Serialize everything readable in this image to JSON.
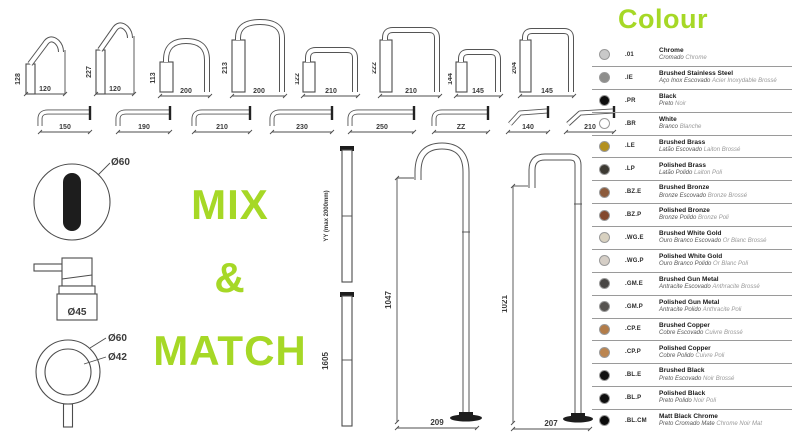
{
  "accent_green": "#a6d826",
  "mix_match": {
    "line1": "MIX",
    "line2": "&",
    "line3": "MATCH"
  },
  "top_spouts": [
    {
      "h": "128",
      "w": "120"
    },
    {
      "h": "227",
      "w": "120"
    },
    {
      "h": "113",
      "w": "200"
    },
    {
      "h": "213",
      "w": "200"
    },
    {
      "h": "122",
      "w": "210"
    },
    {
      "h": "222",
      "w": "210"
    },
    {
      "h": "144",
      "w": "145"
    },
    {
      "h": "204",
      "w": "145"
    }
  ],
  "wall_spouts": [
    {
      "w": "150"
    },
    {
      "w": "190"
    },
    {
      "w": "210"
    },
    {
      "w": "230"
    },
    {
      "w": "250"
    },
    {
      "w": "ZZ"
    },
    {
      "w": "140"
    },
    {
      "w": "210"
    }
  ],
  "handles": {
    "oval_dia": "Ø60",
    "cylinder_dia": "Ø45",
    "ring_outer_dia": "Ø60",
    "ring_inner_dia": "Ø42"
  },
  "risers": [
    {
      "label": "YY (max 2000mm)"
    },
    {
      "label": "1605"
    }
  ],
  "floor_spouts": [
    {
      "h": "1047",
      "w": "209"
    },
    {
      "h": "1021",
      "w": "207"
    }
  ],
  "colour": {
    "title": "Colour",
    "items": [
      {
        "code": ".01",
        "name": "Chrome",
        "sub_pt": "Cromado",
        "sub_fr": "Chrome",
        "hex": "#c9c9c9"
      },
      {
        "code": ".IE",
        "name": "Brushed Stainless Steel",
        "sub_pt": "Aço Inox Escovado",
        "sub_fr": "Acier Inoxydable Brossé",
        "hex": "#8e8e8c"
      },
      {
        "code": ".PR",
        "name": "Black",
        "sub_pt": "Preto",
        "sub_fr": "Noir",
        "hex": "#0d0d0d"
      },
      {
        "code": ".BR",
        "name": "White",
        "sub_pt": "Branco",
        "sub_fr": "Blanche",
        "hex": "#ffffff"
      },
      {
        "code": ".LE",
        "name": "Brushed Brass",
        "sub_pt": "Latão Escovado",
        "sub_fr": "Laiton Brossé",
        "hex": "#b3901f"
      },
      {
        "code": ".LP",
        "name": "Polished Brass",
        "sub_pt": "Latão Polido",
        "sub_fr": "Laiton Poli",
        "hex": "#3d3a33"
      },
      {
        "code": ".BZ.E",
        "name": "Brushed Bronze",
        "sub_pt": "Bronze Escovado",
        "sub_fr": "Bronze Brossé",
        "hex": "#8c5b3c"
      },
      {
        "code": ".BZ.P",
        "name": "Polished Bronze",
        "sub_pt": "Bronze Polido",
        "sub_fr": "Bronze Poli",
        "hex": "#83492e"
      },
      {
        "code": ".WG.E",
        "name": "Brushed White Gold",
        "sub_pt": "Ouro Branco Escovado",
        "sub_fr": "Or Blanc Brossé",
        "hex": "#d8d1c0"
      },
      {
        "code": ".WG.P",
        "name": "Polished White Gold",
        "sub_pt": "Ouro Branco Polido",
        "sub_fr": "Or Blanc Poli",
        "hex": "#d5cec6"
      },
      {
        "code": ".GM.E",
        "name": "Brushed Gun Metal",
        "sub_pt": "Antracite Escovado",
        "sub_fr": "Anthracite Brossé",
        "hex": "#494745"
      },
      {
        "code": ".GM.P",
        "name": "Polished Gun Metal",
        "sub_pt": "Antracite Polido",
        "sub_fr": "Anthracite Poli",
        "hex": "#565350"
      },
      {
        "code": ".CP.E",
        "name": "Brushed Copper",
        "sub_pt": "Cobre Escovado",
        "sub_fr": "Cuivre Brossé",
        "hex": "#b27c49"
      },
      {
        "code": ".CP.P",
        "name": "Polished Copper",
        "sub_pt": "Cobre Polido",
        "sub_fr": "Cuivre Poli",
        "hex": "#bb8550"
      },
      {
        "code": ".BL.E",
        "name": "Brushed Black",
        "sub_pt": "Preto Escovado",
        "sub_fr": "Noir Brossé",
        "hex": "#111111"
      },
      {
        "code": ".BL.P",
        "name": "Polished Black",
        "sub_pt": "Preto Polido",
        "sub_fr": "Noir Poli",
        "hex": "#0f0f0f"
      },
      {
        "code": ".BL.CM",
        "name": "Matt Black Chrome",
        "sub_pt": "Preto Cromado Mate",
        "sub_fr": "Chrome Noir Mat",
        "hex": "#0b0b0b"
      }
    ]
  }
}
